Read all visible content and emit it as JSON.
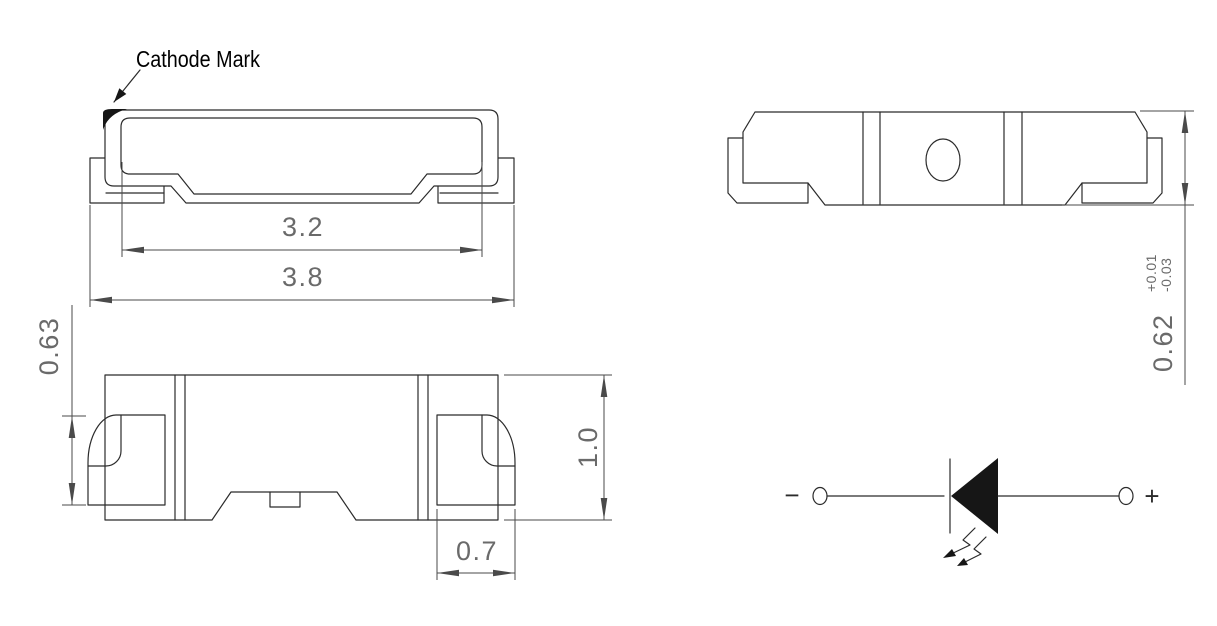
{
  "colors": {
    "background": "#ffffff",
    "outline": "#2b2b2b",
    "dimension_line": "#4a4a4a",
    "dimension_text": "#6a6a6a",
    "callout_text": "#000000",
    "cathode_fill": "#161616"
  },
  "top_view": {
    "callout": "Cathode Mark",
    "dim_body_width": "3.2",
    "dim_overall_width": "3.8"
  },
  "side_view": {
    "dim_terminal_height": "0.63",
    "dim_package_height": "1.0",
    "dim_terminal_width": "0.7"
  },
  "end_view": {
    "dim_thickness": "0.62",
    "dim_thickness_tol_upper": "+0.01",
    "dim_thickness_tol_lower": "-0.03"
  },
  "schematic": {
    "negative_label": "−",
    "positive_label": "+"
  }
}
